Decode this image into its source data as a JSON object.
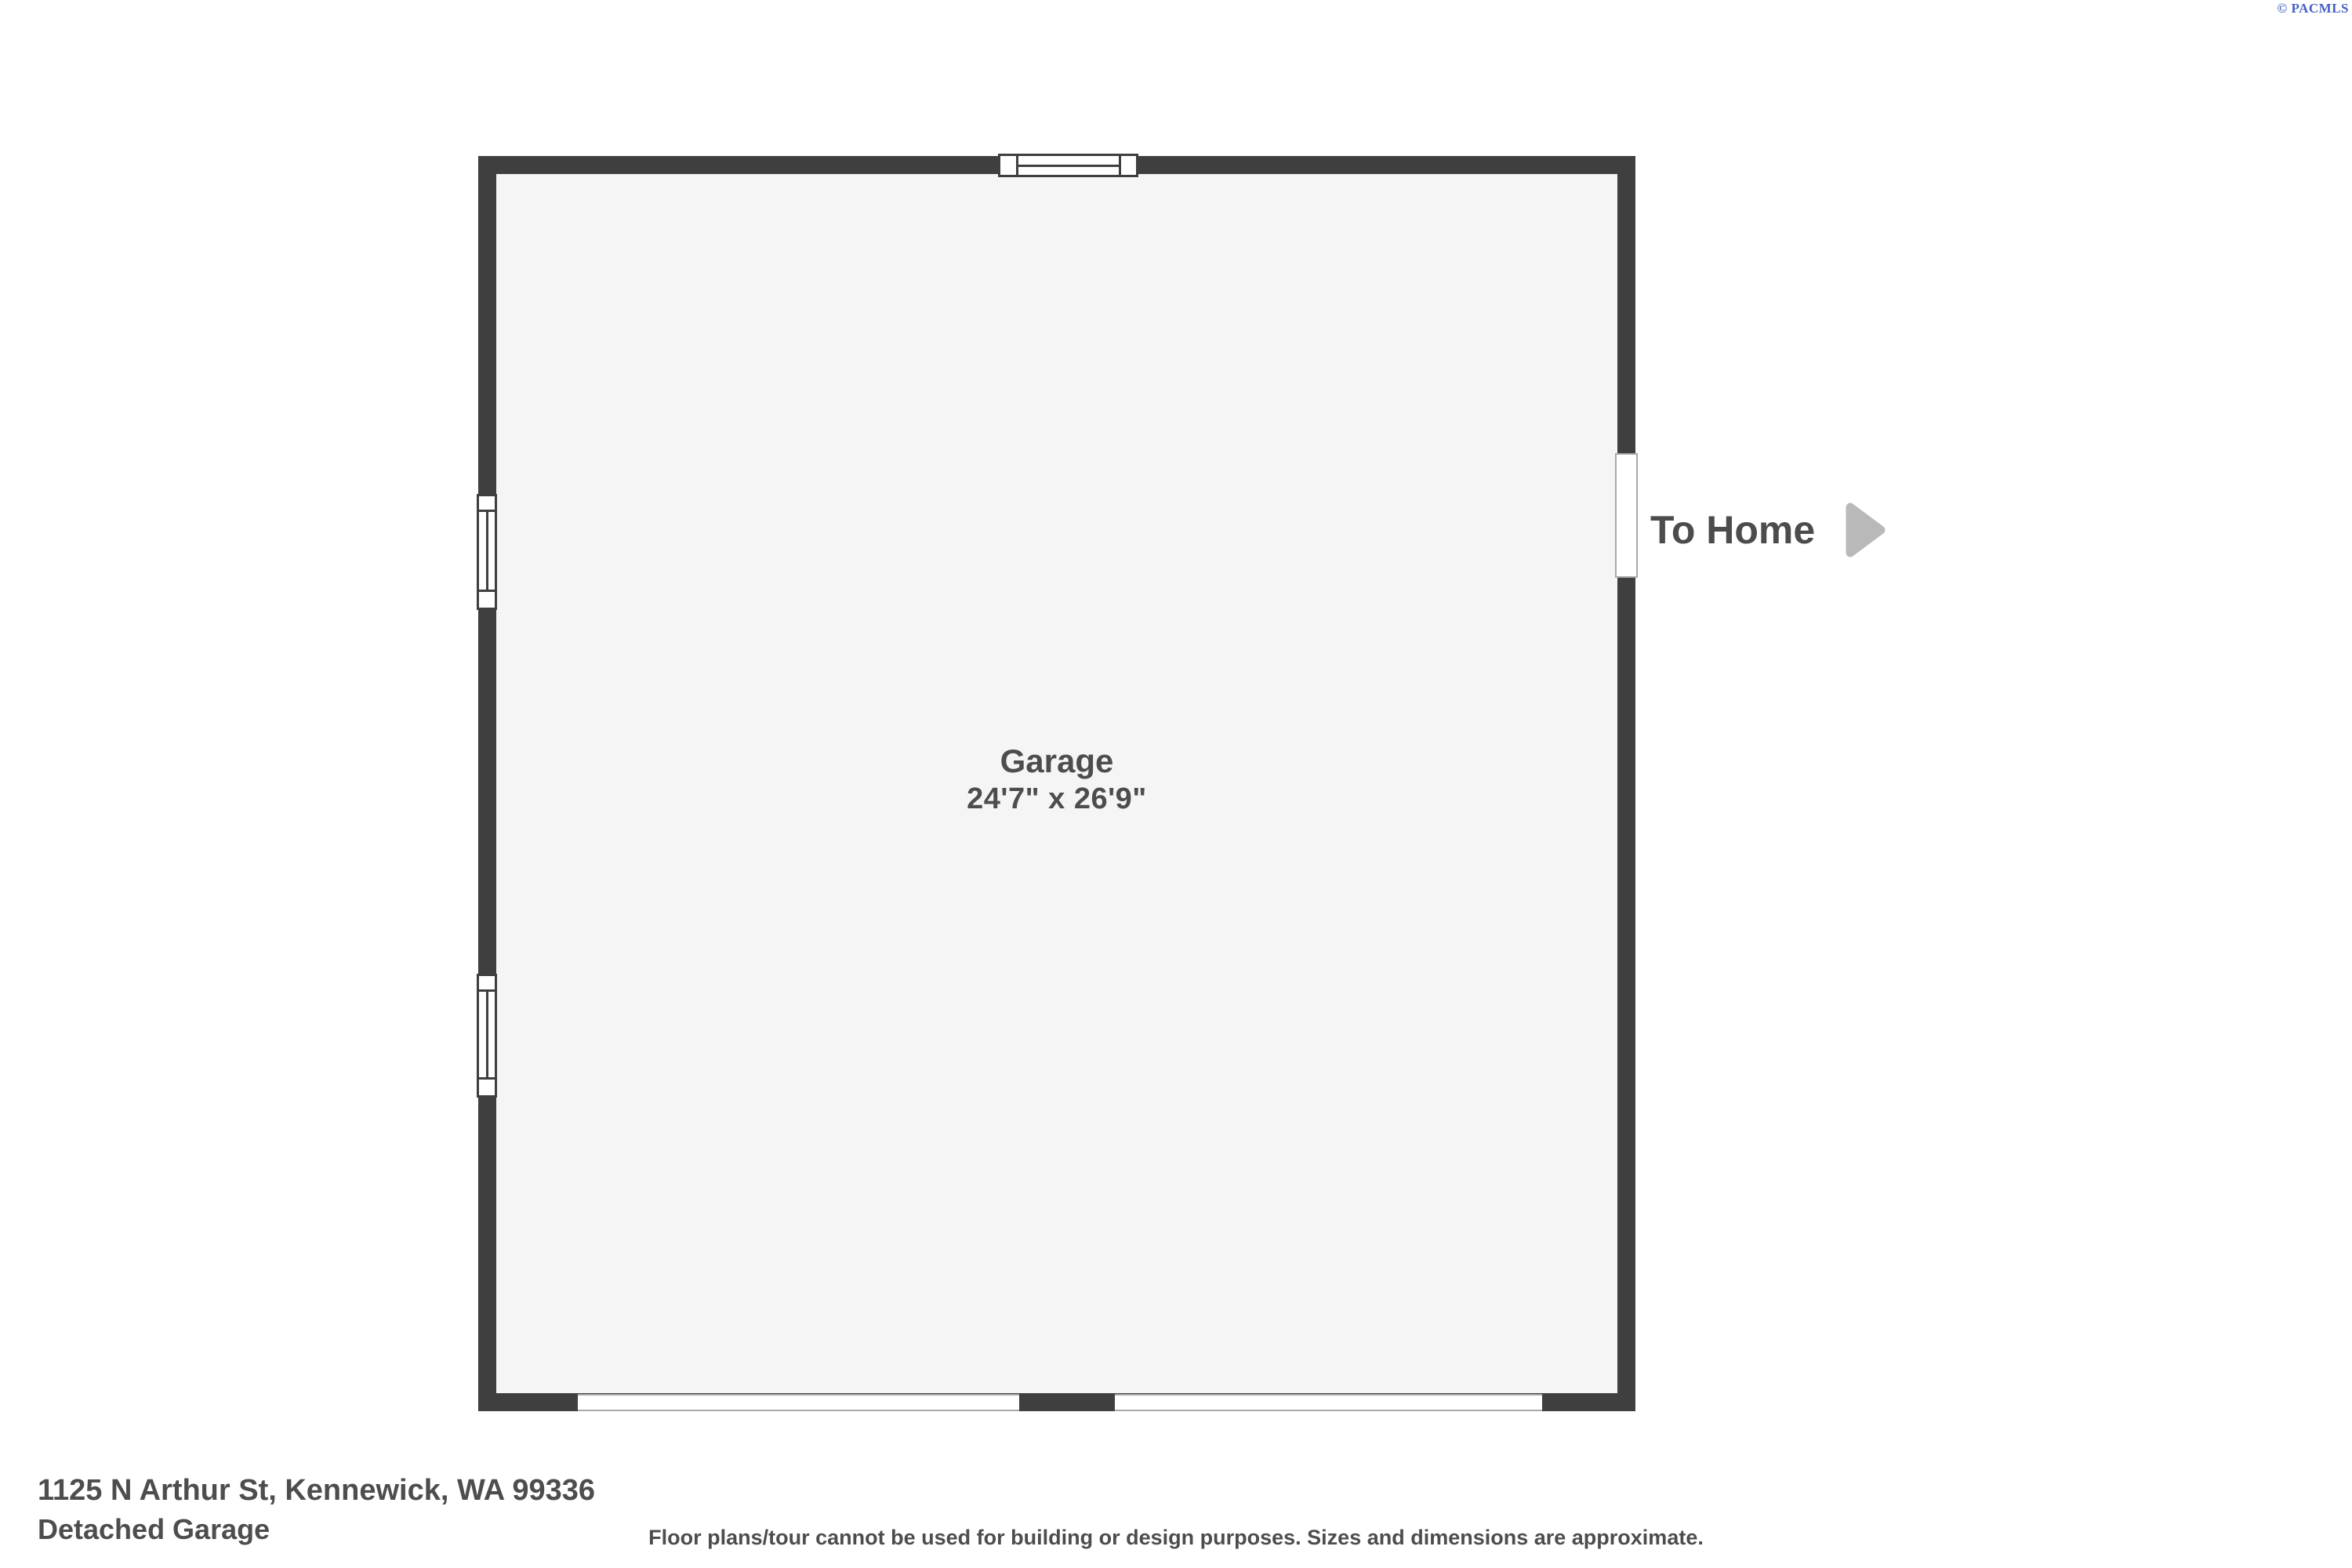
{
  "watermark": {
    "copyright": "© PACMLS",
    "color": "#4560c6"
  },
  "floorplan": {
    "room": {
      "name": "Garage",
      "dimensions": "24'7\" x 26'9\""
    },
    "exit_label": "To Home",
    "openings": {
      "windows": [
        "top-wall-window",
        "left-wall-window-upper",
        "left-wall-window-lower"
      ],
      "garage_doors": [
        "bottom-wall-garage-door-left",
        "bottom-wall-garage-door-right"
      ],
      "doors": [
        "right-wall-door-to-home"
      ]
    },
    "colors": {
      "wall": "#3f3f3f",
      "floor": "#f5f5f5",
      "opening_trim": "#a9a9a9",
      "arrow": "#b9b9b9",
      "label_text": "#4d4d4d"
    }
  },
  "footer": {
    "address": "1125 N Arthur St, Kennewick, WA 99336",
    "plan_name": "Detached Garage",
    "disclaimer": "Floor plans/tour cannot be used for building or design purposes. Sizes and dimensions are approximate."
  }
}
